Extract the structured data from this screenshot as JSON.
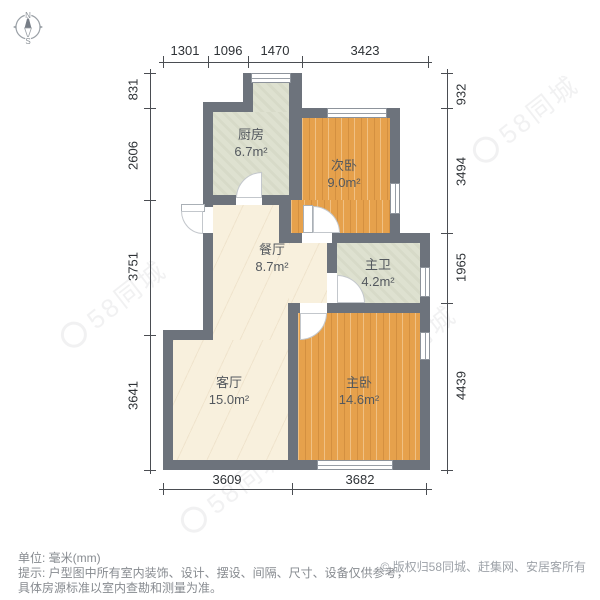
{
  "compass": {
    "north": "N",
    "south": "S"
  },
  "dimensions": {
    "unit": "mm",
    "top": [
      "1301",
      "1096",
      "1470",
      "3423"
    ],
    "left": [
      "831",
      "2606",
      "3751",
      "3641"
    ],
    "right": [
      "932",
      "3494",
      "1965",
      "4439"
    ],
    "bottom": [
      "3609",
      "3682"
    ]
  },
  "rooms": [
    {
      "id": "kitchen",
      "name": "厨房",
      "area": "6.7m²"
    },
    {
      "id": "second-bedroom",
      "name": "次卧",
      "area": "9.0m²"
    },
    {
      "id": "dining-room",
      "name": "餐厅",
      "area": "8.7m²"
    },
    {
      "id": "master-bathroom",
      "name": "主卫",
      "area": "4.2m²"
    },
    {
      "id": "living-room",
      "name": "客厅",
      "area": "15.0m²"
    },
    {
      "id": "master-bedroom",
      "name": "主卧",
      "area": "14.6m²"
    }
  ],
  "watermark": {
    "text": "58同城"
  },
  "footer": {
    "unit_label": "单位: 毫米(mm)",
    "tip_line1": "提示: 户型图中所有室内装饰、设计、摆设、间隔、尺寸、设备仅供参考，",
    "tip_line2": "具体房源标准以室内查勘和测量为准。",
    "copyright": "© 版权归58同城、赶集网、安居客所有"
  },
  "colors": {
    "wall": "#6d737c",
    "wood_floor": "#e6a14c",
    "tile_floor": "#dee1d0",
    "marble_floor": "#f8f0dd"
  }
}
